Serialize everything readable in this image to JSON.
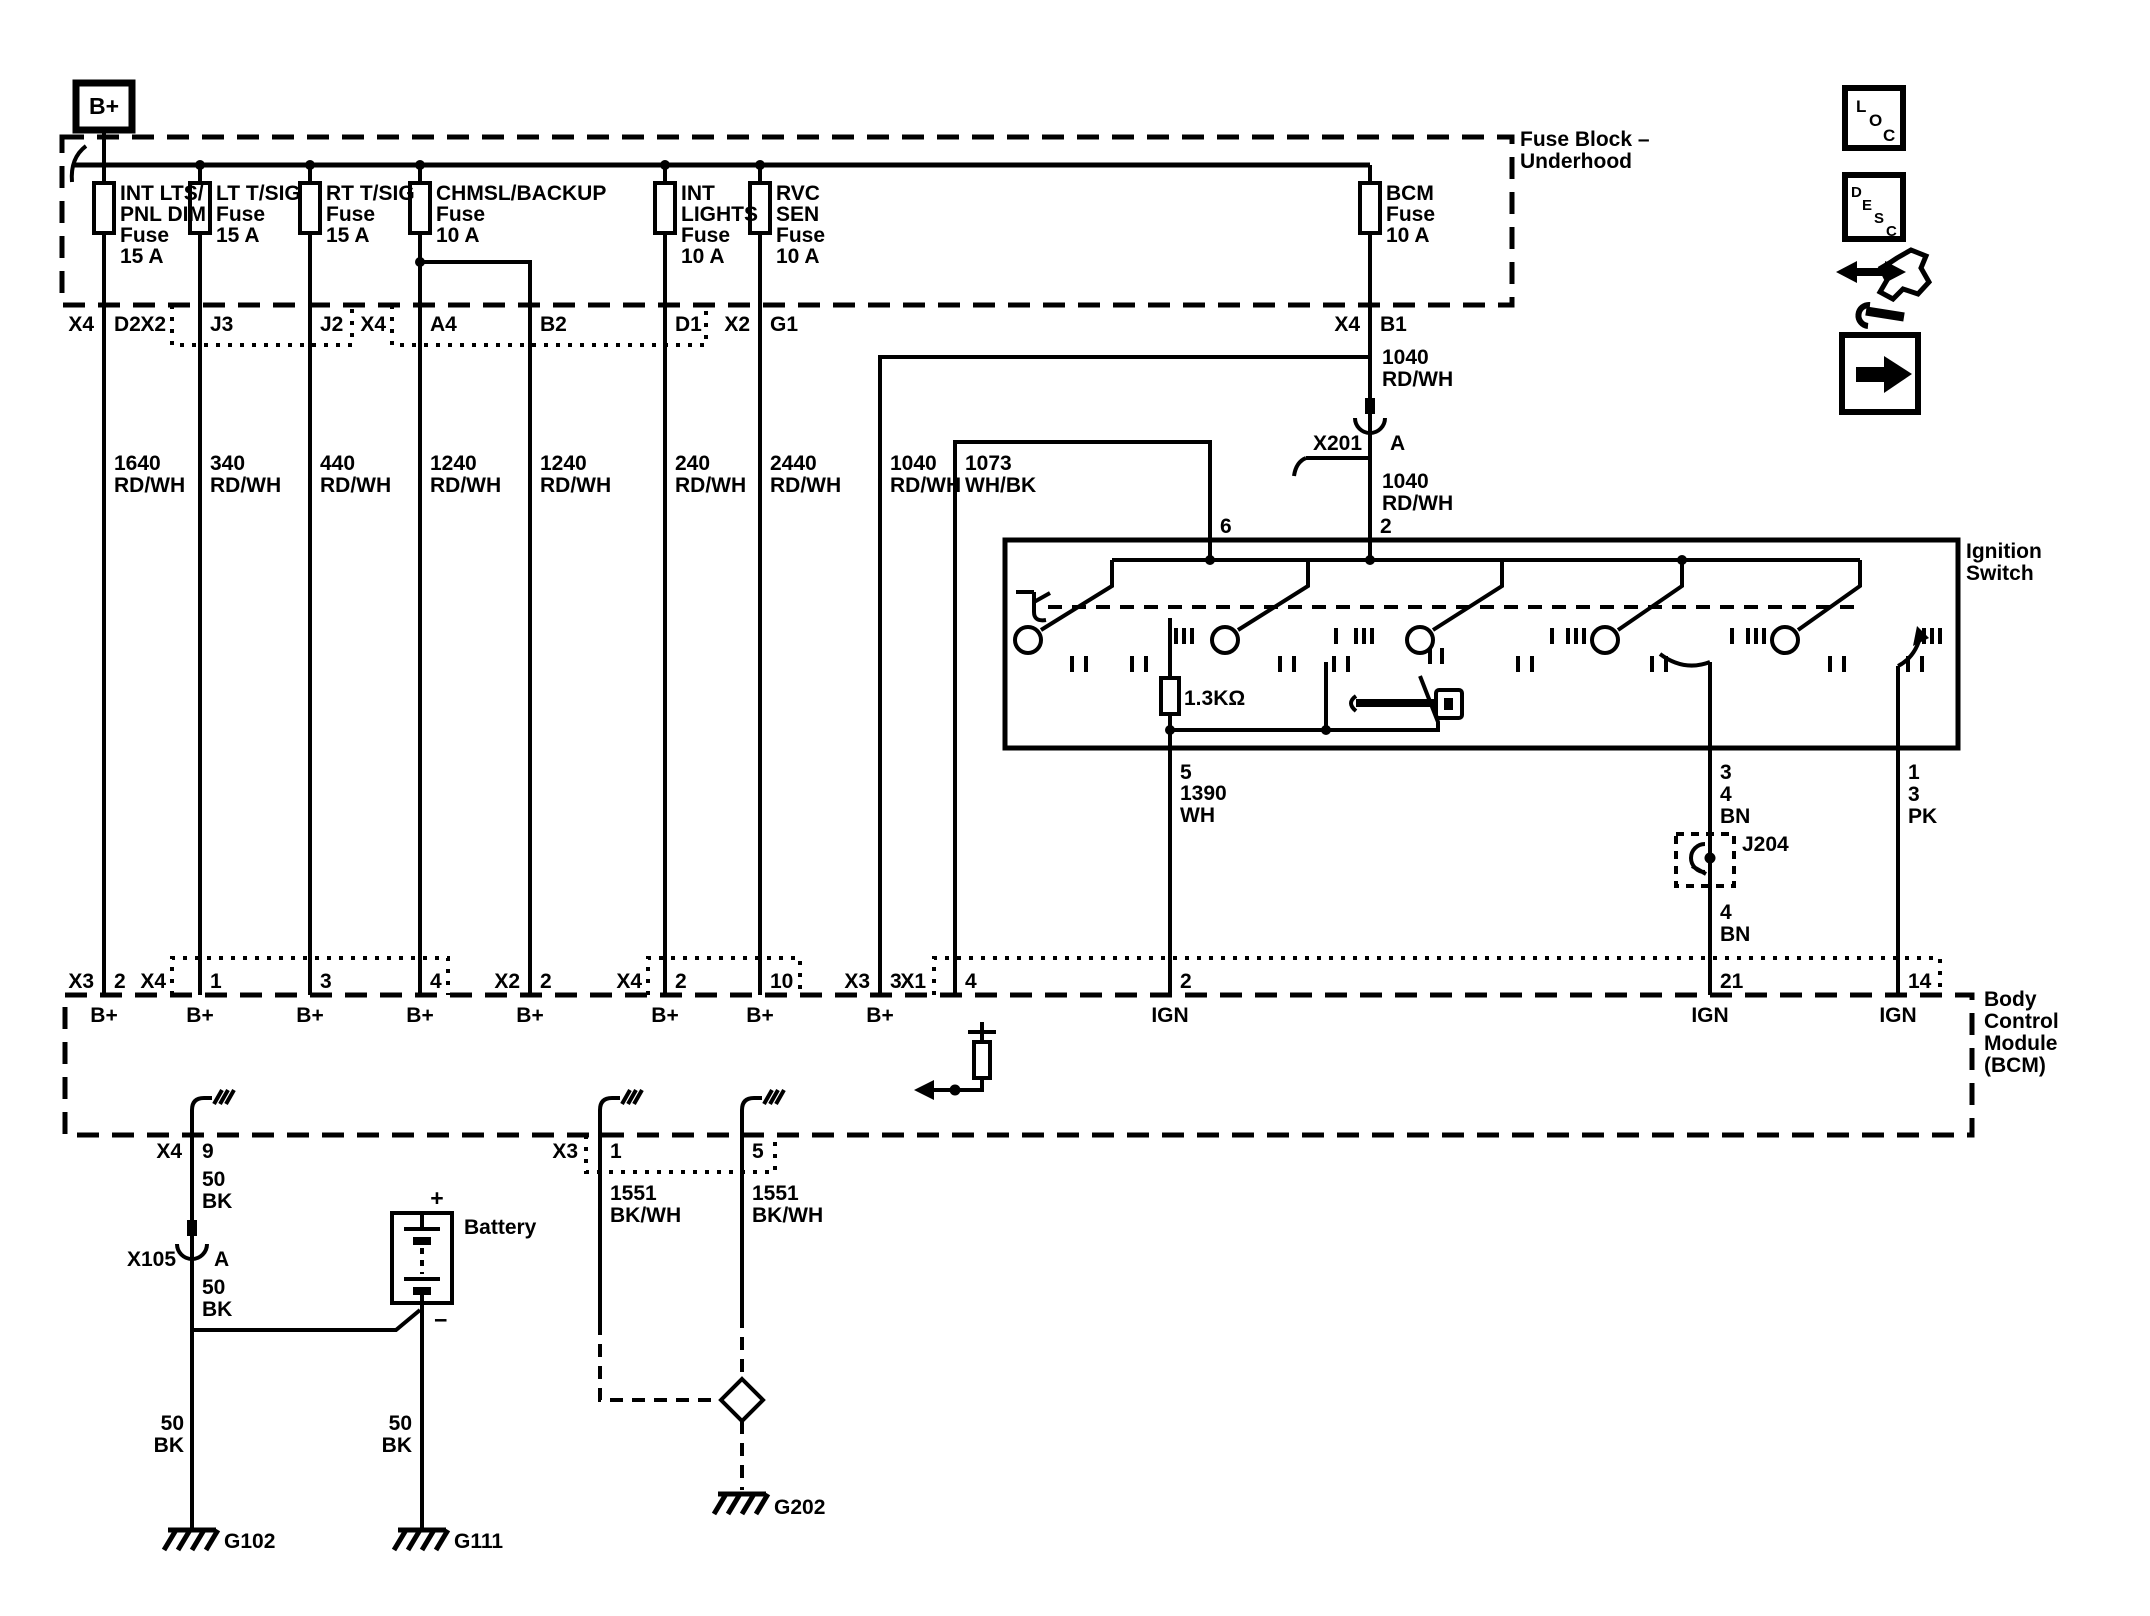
{
  "b_plus_label": "B+",
  "fuse_block": {
    "name_l1": "Fuse Block –",
    "name_l2": "Underhood",
    "fuses": [
      {
        "l1": "INT LTS/",
        "l2": "PNL DIM",
        "l3": "Fuse",
        "l4": "15 A"
      },
      {
        "l1": "LT T/SIG",
        "l2": "Fuse",
        "l3": "15 A"
      },
      {
        "l1": "RT T/SIG",
        "l2": "Fuse",
        "l3": "15 A"
      },
      {
        "l1": "CHMSL/BACKUP",
        "l2": "Fuse",
        "l3": "10 A"
      },
      {
        "l1": "INT",
        "l2": "LIGHTS",
        "l3": "Fuse",
        "l4": "10 A"
      },
      {
        "l1": "RVC",
        "l2": "SEN",
        "l3": "Fuse",
        "l4": "10 A"
      },
      {
        "l1": "BCM",
        "l2": "Fuse",
        "l3": "10 A"
      }
    ],
    "pins": [
      {
        "conn": "X4",
        "cav": "D2"
      },
      {
        "conn": "X2",
        "cav": "J3"
      },
      {
        "cav": "J2"
      },
      {
        "conn": "X4",
        "cav": "A4"
      },
      {
        "cav": "B2"
      },
      {
        "cav": "D1"
      },
      {
        "conn": "X2",
        "cav": "G1"
      },
      {
        "conn": "X4",
        "cav": "B1"
      }
    ]
  },
  "wires": [
    {
      "circuit": "1640",
      "color": "RD/WH"
    },
    {
      "circuit": "340",
      "color": "RD/WH"
    },
    {
      "circuit": "440",
      "color": "RD/WH"
    },
    {
      "circuit": "1240",
      "color": "RD/WH"
    },
    {
      "circuit": "1240",
      "color": "RD/WH"
    },
    {
      "circuit": "240",
      "color": "RD/WH"
    },
    {
      "circuit": "2440",
      "color": "RD/WH"
    },
    {
      "circuit": "1040",
      "color": "RD/WH"
    },
    {
      "circuit": "1073",
      "color": "WH/BK"
    },
    {
      "circuit": "1040",
      "color": "RD/WH"
    },
    {
      "circuit": "1040",
      "color": "RD/WH"
    },
    {
      "circuit": "1390",
      "color": "WH"
    },
    {
      "circuit": "4",
      "color": "BN"
    },
    {
      "circuit": "4",
      "color": "BN"
    },
    {
      "circuit": "3",
      "color": "PK"
    },
    {
      "circuit": "50",
      "color": "BK"
    },
    {
      "circuit": "50",
      "color": "BK"
    },
    {
      "circuit": "50",
      "color": "BK"
    },
    {
      "circuit": "50",
      "color": "BK"
    },
    {
      "circuit": "1551",
      "color": "BK/WH"
    },
    {
      "circuit": "1551",
      "color": "BK/WH"
    }
  ],
  "ignition_switch": {
    "name_l1": "Ignition",
    "name_l2": "Switch",
    "resistor_value": "1.3KΩ",
    "pin_top_left": "6",
    "pin_top_right": "2",
    "pin_bottom_1": "5",
    "pin_bottom_2": "3",
    "pin_bottom_3": "1"
  },
  "splices": {
    "x201": {
      "label": "X201",
      "cavity": "A"
    },
    "x105": {
      "label": "X105",
      "cavity": "A"
    },
    "j204": {
      "label": "J204"
    }
  },
  "bcm": {
    "name_l1": "Body",
    "name_l2": "Control",
    "name_l3": "Module",
    "name_l4": "(BCM)",
    "top_pins": [
      {
        "conn": "X3",
        "cav": "2",
        "fn": "B+"
      },
      {
        "conn": "X4",
        "cav": "1",
        "fn": "B+"
      },
      {
        "cav": "3",
        "fn": "B+"
      },
      {
        "cav": "4",
        "fn": "B+"
      },
      {
        "conn": "X2",
        "cav": "2",
        "fn": "B+"
      },
      {
        "conn": "X4",
        "cav": "2",
        "fn": "B+"
      },
      {
        "cav": "10",
        "fn": "B+"
      },
      {
        "conn": "X3",
        "cav": "3",
        "fn": "B+"
      },
      {
        "conn": "X1",
        "cav": "4",
        "fn": ""
      },
      {
        "cav": "2",
        "fn": "IGN"
      },
      {
        "cav": "21",
        "fn": "IGN"
      },
      {
        "cav": "14",
        "fn": "IGN"
      }
    ],
    "bottom_pins": [
      {
        "conn": "X4",
        "cav": "9"
      },
      {
        "conn": "X3",
        "cav": "1"
      },
      {
        "cav": "5"
      }
    ]
  },
  "battery": {
    "label": "Battery",
    "positive": "+",
    "negative": "−"
  },
  "grounds": [
    {
      "id": "G102"
    },
    {
      "id": "G111"
    },
    {
      "id": "G202"
    }
  ],
  "nav": {
    "loc": [
      "L",
      "O",
      "C"
    ],
    "desc": [
      "D",
      "E",
      "S",
      "C"
    ]
  }
}
